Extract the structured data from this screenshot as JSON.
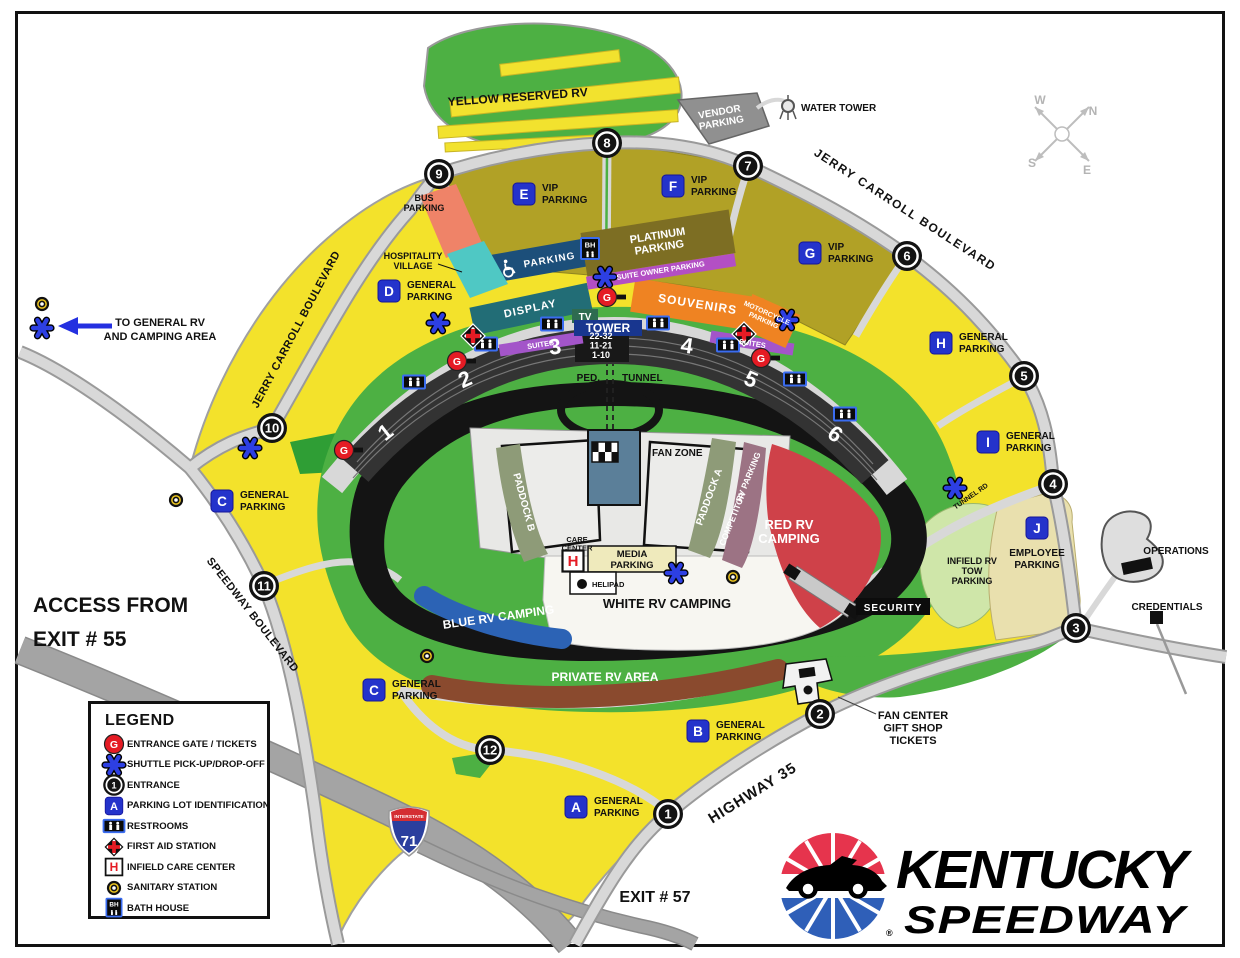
{
  "palette": {
    "yellow": "#f3e22b",
    "olive": "#b1a126",
    "green": "#4db043",
    "dark_green": "#2f9e35",
    "road": "#d8d8d8",
    "freeway": "#a4a4a4",
    "track": "#141414",
    "red_rv": "#cf4149",
    "brown_rv": "#8a4a2e",
    "blue_rv": "#2c63b5",
    "white_rv": "#f7f6f1",
    "media": "#efeabc",
    "paddock": "#8e9b78",
    "competitor": "#9c7384",
    "bus": "#ef8368",
    "hospitality": "#4fc8c4",
    "display": "#226d76",
    "handicap": "#1c4f7a",
    "souvenirs": "#ef8322",
    "suites": "#a355c9",
    "suite_owner": "#b34fc4",
    "platinum": "#7d6e23",
    "vendor": "#909090",
    "employee": "#e9e0ae",
    "tow": "#cfe6a9",
    "badge_blue": "#2433cb",
    "gate_red": "#e51b24",
    "shuttle_blue": "#2d3fe3",
    "sanitary_yellow": "#ecc520"
  },
  "legend": {
    "title": "LEGEND",
    "entrance_number": "1",
    "lot_letter": "A",
    "gate_letter": "G",
    "bath_house": "BH",
    "care_letter": "H",
    "items": [
      {
        "icon": "entrance-gate-icon",
        "label": "ENTRANCE GATE / TICKETS"
      },
      {
        "icon": "shuttle-icon",
        "label": "SHUTTLE PICK-UP/DROP-OFF"
      },
      {
        "icon": "entrance-number-icon",
        "label": "ENTRANCE"
      },
      {
        "icon": "parking-lot-id-icon",
        "label": "PARKING LOT IDENTIFICATION"
      },
      {
        "icon": "restrooms-icon",
        "label": "RESTROOMS"
      },
      {
        "icon": "first-aid-icon",
        "label": "FIRST AID STATION"
      },
      {
        "icon": "infield-care-center-icon",
        "label": "INFIELD CARE CENTER"
      },
      {
        "icon": "sanitary-station-icon",
        "label": "SANITARY STATION"
      },
      {
        "icon": "bath-house-icon",
        "label": "BATH HOUSE"
      }
    ]
  },
  "logo": {
    "line1": "KENTUCKY",
    "line2": "SPEEDWAY",
    "reg": "®"
  },
  "interstate": {
    "top": "INTERSTATE",
    "number": "71"
  },
  "compass": {
    "w": "W",
    "n": "N",
    "s": "S",
    "e": "E"
  },
  "entrances": [
    {
      "n": "1",
      "x": 668,
      "y": 814
    },
    {
      "n": "2",
      "x": 820,
      "y": 714
    },
    {
      "n": "3",
      "x": 1076,
      "y": 628
    },
    {
      "n": "4",
      "x": 1053,
      "y": 484
    },
    {
      "n": "5",
      "x": 1024,
      "y": 376
    },
    {
      "n": "6",
      "x": 907,
      "y": 256
    },
    {
      "n": "7",
      "x": 748,
      "y": 166
    },
    {
      "n": "8",
      "x": 607,
      "y": 143
    },
    {
      "n": "9",
      "x": 439,
      "y": 174
    },
    {
      "n": "10",
      "x": 272,
      "y": 428
    },
    {
      "n": "11",
      "x": 264,
      "y": 586
    },
    {
      "n": "12",
      "x": 490,
      "y": 750
    }
  ],
  "gates": [
    {
      "x": 607,
      "y": 297
    },
    {
      "x": 457,
      "y": 361
    },
    {
      "x": 761,
      "y": 358
    },
    {
      "x": 344,
      "y": 450
    }
  ],
  "lots": [
    {
      "id": "A",
      "x": 576,
      "y": 807,
      "lines": [
        "GENERAL",
        "PARKING"
      ],
      "pos": "right"
    },
    {
      "id": "B",
      "x": 698,
      "y": 731,
      "lines": [
        "GENERAL",
        "PARKING"
      ],
      "pos": "right"
    },
    {
      "id": "C",
      "x": 222,
      "y": 501,
      "lines": [
        "GENERAL",
        "PARKING"
      ],
      "pos": "right"
    },
    {
      "id": "C",
      "x": 374,
      "y": 690,
      "lines": [
        "GENERAL",
        "PARKING"
      ],
      "pos": "right"
    },
    {
      "id": "D",
      "x": 389,
      "y": 291,
      "lines": [
        "GENERAL",
        "PARKING"
      ],
      "pos": "right"
    },
    {
      "id": "E",
      "x": 524,
      "y": 194,
      "lines": [
        "VIP",
        "PARKING"
      ],
      "pos": "right"
    },
    {
      "id": "F",
      "x": 673,
      "y": 186,
      "lines": [
        "VIP",
        "PARKING"
      ],
      "pos": "right"
    },
    {
      "id": "G",
      "x": 810,
      "y": 253,
      "lines": [
        "VIP",
        "PARKING"
      ],
      "pos": "right"
    },
    {
      "id": "H",
      "x": 941,
      "y": 343,
      "lines": [
        "GENERAL",
        "PARKING"
      ],
      "pos": "right"
    },
    {
      "id": "I",
      "x": 988,
      "y": 442,
      "lines": [
        "GENERAL",
        "PARKING"
      ],
      "pos": "right"
    },
    {
      "id": "J",
      "x": 1037,
      "y": 528,
      "lines": [
        "EMPLOYEE",
        "PARKING"
      ],
      "pos": "below"
    }
  ],
  "shuttles": [
    [
      42,
      328
    ],
    [
      438,
      323
    ],
    [
      605,
      277
    ],
    [
      787,
      320
    ],
    [
      955,
      488
    ],
    [
      676,
      573
    ],
    [
      250,
      448
    ]
  ],
  "sanitary": [
    [
      42,
      304
    ],
    [
      176,
      500
    ],
    [
      427,
      656
    ],
    [
      733,
      577
    ]
  ],
  "restrooms": [
    [
      552,
      324
    ],
    [
      658,
      323
    ],
    [
      486,
      344
    ],
    [
      728,
      345
    ],
    [
      414,
      382
    ],
    [
      795,
      379
    ],
    [
      845,
      414
    ]
  ],
  "first_aid": [
    [
      473,
      336
    ],
    [
      744,
      334
    ]
  ],
  "bath_houses": [
    [
      590,
      249
    ]
  ],
  "care_centers": [
    [
      573,
      561
    ]
  ],
  "labels": [
    {
      "n": "yellow-reserved-rv-label",
      "t": "YELLOW RESERVED RV",
      "x": 518,
      "y": 101,
      "s": 12,
      "r": -4
    },
    {
      "n": "vendor-parking-label",
      "L": [
        "VENDOR",
        "PARKING"
      ],
      "x": 720,
      "y": 115,
      "s": 10,
      "r": -10,
      "c": "#fff",
      "lh": 11
    },
    {
      "n": "water-tower-label",
      "t": "WATER TOWER",
      "x": 801,
      "y": 111,
      "s": 10,
      "a": "start"
    },
    {
      "n": "jerry-carroll-blvd-right-label",
      "t": "JERRY CARROLL BOULEVARD",
      "x": 903,
      "y": 213,
      "s": 12,
      "r": 33,
      "ls": 1.5
    },
    {
      "n": "jerry-carroll-blvd-left-label",
      "t": "JERRY CARROLL BOULEVARD",
      "x": 299,
      "y": 331,
      "s": 11,
      "r": -62,
      "ls": 0.5
    },
    {
      "n": "bus-parking-label",
      "L": [
        "BUS",
        "PARKING"
      ],
      "x": 424,
      "y": 201,
      "s": 9,
      "lh": 10
    },
    {
      "n": "hospitality-village-label",
      "L": [
        "HOSPITALITY",
        "VILLAGE"
      ],
      "x": 413,
      "y": 259,
      "s": 9,
      "lh": 10
    },
    {
      "n": "platinum-parking-label",
      "L": [
        "PLATINUM",
        "PARKING"
      ],
      "x": 658,
      "y": 239,
      "s": 11,
      "r": -9,
      "c": "#fff",
      "lh": 12
    },
    {
      "n": "suite-owner-parking-label",
      "t": "SUITE OWNER PARKING",
      "x": 661,
      "y": 273,
      "s": 7.5,
      "r": -9,
      "c": "#fff"
    },
    {
      "n": "handicap-parking-label",
      "t": "PARKING",
      "x": 550,
      "y": 263,
      "s": 10,
      "r": -10,
      "c": "#fff",
      "ls": 1
    },
    {
      "n": "display-label",
      "t": "DISPLAY",
      "x": 531,
      "y": 312,
      "s": 11,
      "r": -12,
      "c": "#fff",
      "ls": 1
    },
    {
      "n": "souvenirs-label",
      "t": "SOUVENIRS",
      "x": 697,
      "y": 308,
      "s": 12,
      "r": 9,
      "c": "#fff",
      "ls": 1
    },
    {
      "n": "motorcycle-parking-label",
      "L": [
        "MOTORCYCLE",
        "PARKING"
      ],
      "x": 766,
      "y": 315,
      "s": 7,
      "r": 24,
      "c": "#fff",
      "lh": 8
    },
    {
      "n": "tv-label",
      "t": "TV",
      "x": 585,
      "y": 320,
      "s": 10,
      "c": "#fff"
    },
    {
      "n": "tower-label",
      "t": "TOWER",
      "x": 608,
      "y": 332,
      "s": 12,
      "c": "#fff"
    },
    {
      "n": "suites-left-label",
      "t": "SUITES",
      "x": 541,
      "y": 347,
      "s": 7.5,
      "r": -9,
      "c": "#fff"
    },
    {
      "n": "suites-right-label",
      "t": "SUITES",
      "x": 752,
      "y": 346,
      "s": 7.5,
      "r": 9,
      "c": "#fff"
    },
    {
      "n": "grandstand-rows-label",
      "L": [
        "22-32",
        "11-21",
        "1-10"
      ],
      "x": 601,
      "y": 339,
      "s": 9,
      "c": "#fff",
      "lh": 9.5
    },
    {
      "n": "section-1-label",
      "t": "1",
      "x": 390,
      "y": 438,
      "s": 22,
      "r": -38,
      "c": "#fff"
    },
    {
      "n": "section-2-label",
      "t": "2",
      "x": 468,
      "y": 386,
      "s": 22,
      "r": -24,
      "c": "#fff"
    },
    {
      "n": "section-3-label",
      "t": "3",
      "x": 556,
      "y": 354,
      "s": 22,
      "r": -8,
      "c": "#fff"
    },
    {
      "n": "section-4-label",
      "t": "4",
      "x": 686,
      "y": 353,
      "s": 22,
      "r": 8,
      "c": "#fff"
    },
    {
      "n": "section-5-label",
      "t": "5",
      "x": 748,
      "y": 386,
      "s": 22,
      "r": 24,
      "c": "#fff"
    },
    {
      "n": "section-6-label",
      "t": "6",
      "x": 831,
      "y": 440,
      "s": 22,
      "r": 36,
      "c": "#fff"
    },
    {
      "n": "ped-label",
      "t": "PED.",
      "x": 600,
      "y": 381,
      "s": 10,
      "a": "end"
    },
    {
      "n": "tunnel-label",
      "t": "TUNNEL",
      "x": 622,
      "y": 381,
      "s": 10,
      "a": "start"
    },
    {
      "n": "fan-zone-label",
      "t": "FAN ZONE",
      "x": 652,
      "y": 456,
      "s": 10,
      "a": "start"
    },
    {
      "n": "paddock-b-label",
      "t": "PADDOCK B",
      "x": 521,
      "y": 503,
      "s": 10,
      "r": 75,
      "c": "#fff"
    },
    {
      "n": "paddock-a-label",
      "t": "PADDOCK A",
      "x": 712,
      "y": 498,
      "s": 10,
      "r": -70,
      "c": "#fff"
    },
    {
      "n": "competitor-label",
      "t": "COMPETITOR",
      "x": 735,
      "y": 520,
      "s": 8.5,
      "r": -68,
      "c": "#fff"
    },
    {
      "n": "competitor-rv-label",
      "t": "RV PARKING",
      "x": 751,
      "y": 478,
      "s": 8.5,
      "r": -68,
      "c": "#fff"
    },
    {
      "n": "red-rv-camping-label",
      "L": [
        "RED RV",
        "CAMPING"
      ],
      "x": 789,
      "y": 529,
      "s": 13,
      "c": "#fff",
      "lh": 14
    },
    {
      "n": "care-center-label",
      "L": [
        "CARE",
        "CENTER"
      ],
      "x": 577,
      "y": 542,
      "s": 7.5,
      "lh": 8.5
    },
    {
      "n": "media-parking-label",
      "L": [
        "MEDIA",
        "PARKING"
      ],
      "x": 632,
      "y": 557,
      "s": 9.5,
      "lh": 11
    },
    {
      "n": "helipad-label",
      "t": "HELIPAD",
      "x": 592,
      "y": 587,
      "s": 7.5,
      "a": "start"
    },
    {
      "n": "white-rv-camping-label",
      "t": "WHITE RV CAMPING",
      "x": 667,
      "y": 608,
      "s": 13
    },
    {
      "n": "blue-rv-camping-label",
      "t": "BLUE  RV CAMPING",
      "x": 499,
      "y": 621,
      "s": 12,
      "r": -8,
      "c": "#fff"
    },
    {
      "n": "private-rv-area-label",
      "t": "PRIVATE RV AREA",
      "x": 605,
      "y": 681,
      "s": 12,
      "c": "#fff"
    },
    {
      "n": "security-label",
      "t": "SECURITY",
      "x": 893,
      "y": 611,
      "s": 10,
      "c": "#fff",
      "ls": 1
    },
    {
      "n": "infield-rv-tow-label",
      "L": [
        "INFIELD RV",
        "TOW",
        "PARKING"
      ],
      "x": 972,
      "y": 564,
      "s": 9,
      "lh": 10
    },
    {
      "n": "tunnel-rd-label",
      "t": "TUNNEL RD",
      "x": 972,
      "y": 498,
      "s": 7,
      "r": -35
    },
    {
      "n": "operations-label",
      "t": "OPERATIONS",
      "x": 1176,
      "y": 554,
      "s": 10
    },
    {
      "n": "credentials-label",
      "t": "CREDENTIALS",
      "x": 1167,
      "y": 610,
      "s": 10
    },
    {
      "n": "fan-center-label",
      "L": [
        "FAN CENTER",
        "GIFT SHOP",
        "TICKETS"
      ],
      "x": 913,
      "y": 719,
      "s": 11,
      "lh": 12.5
    },
    {
      "n": "highway-35-label",
      "t": "HIGHWAY 35",
      "x": 755,
      "y": 797,
      "s": 15,
      "r": -32,
      "ls": 1
    },
    {
      "n": "exit-57-label",
      "t": "EXIT # 57",
      "x": 655,
      "y": 902,
      "s": 16
    },
    {
      "n": "access-exit-55-label",
      "L": [
        "ACCESS FROM",
        "EXIT # 55"
      ],
      "x": 33,
      "y": 612,
      "s": 21,
      "a": "start",
      "lh": 34
    },
    {
      "n": "to-general-rv-label",
      "L": [
        "TO GENERAL RV",
        "AND CAMPING AREA"
      ],
      "x": 160,
      "y": 326,
      "s": 11,
      "lh": 14
    },
    {
      "n": "speedway-blvd-label",
      "t": "SPEEDWAY BOULEVARD",
      "x": 250,
      "y": 617,
      "s": 11,
      "r": 52,
      "ls": 0.5
    }
  ]
}
